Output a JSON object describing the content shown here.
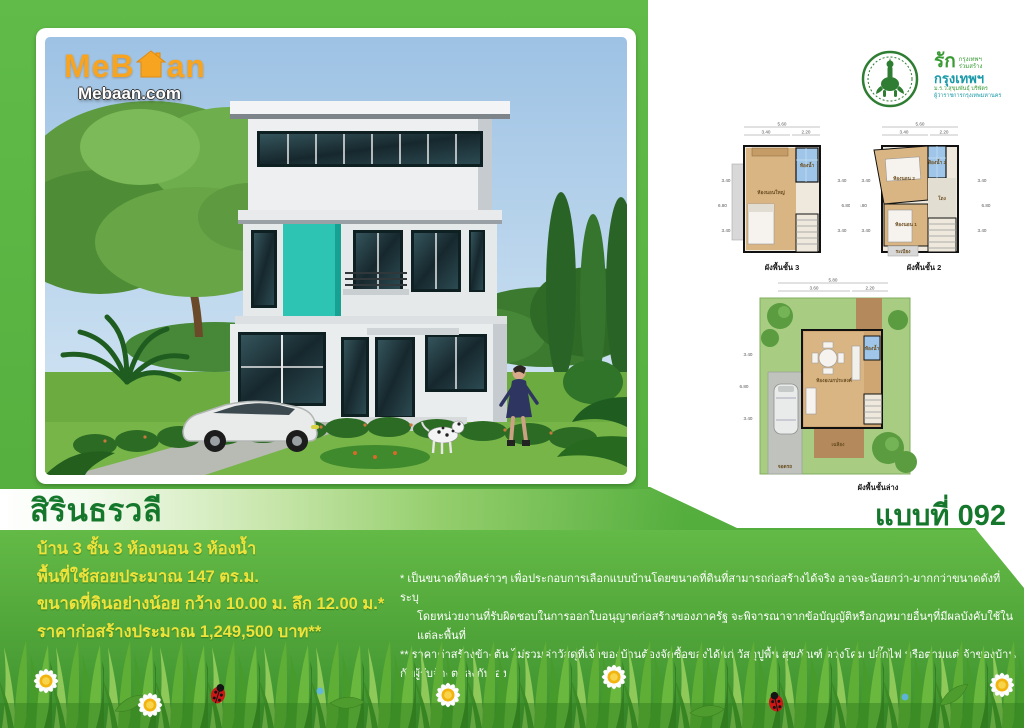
{
  "brand": {
    "name_part1": "MeB",
    "name_part2": "an",
    "house_icon": "house-icon",
    "site": "Mebaan.com"
  },
  "header": {
    "model_label": "แบบที่ 092",
    "campaign": {
      "love": "รัก",
      "top_small_1": "กรุงเทพฯ",
      "top_small_2": "ร่วมสร้าง",
      "main": "กรุงเทพฯ",
      "sub1": "ม.ร.ว.สุขุมพันธุ์ บริพัตร",
      "sub2": "ผู้ว่าราชการกรุงเทพมหานคร"
    }
  },
  "title": {
    "name": "สิรินธรวลี"
  },
  "specs": {
    "lines": [
      "บ้าน 3 ชั้น 3 ห้องนอน 3 ห้องน้ำ",
      "พื้นที่ใช้สอยประมาณ 147 ตร.ม.",
      "ขนาดที่ดินอย่างน้อย กว้าง 10.00 ม. ลึก 12.00 ม.*",
      "ราคาก่อสร้างประมาณ 1,249,500 บาท**"
    ]
  },
  "disclaimer": {
    "lines": [
      "* เป็นขนาดที่ดินคร่าวๆ  เพื่อประกอบการเลือกแบบบ้านโดยขนาดที่ดินที่สามารถก่อสร้างได้จริง  อาจจะน้อยกว่า-มากกว่าขนาดดังที่ระบุ",
      "โดยหน่วยงานที่รับผิดชอบในการออกใบอนุญาตก่อสร้างของภาครัฐ  จะพิจารณาจากข้อบัญญัติหรือกฎหมายอื่นๆที่มีผลบังคับใช้ในแต่ละพื้นที่",
      "** ราคาค่าสร้างข้างต้น ไม่รวมค่าวัสดุที่เจ้าของบ้านต้องจัดซื้อของได้แก่ วัสดุปูพื้น สุขภัณฑ์ ดวงโคม ปลั๊กไฟ หรือตามแต่เจ้าของบ้านกับผู้รับจ้างตกลงกันเอง"
    ]
  },
  "plans": {
    "floor3": {
      "caption": "ผังพื้นชั้น 3",
      "dims_top": [
        "5.60",
        "3.40",
        "2.20"
      ],
      "dims_side": [
        "3.40",
        "6.80",
        "3.40"
      ],
      "room_master": "ห้องนอนใหญ่",
      "room_bath": "ห้องน้ำ"
    },
    "floor2": {
      "caption": "ผังพื้นชั้น 2",
      "dims_top": [
        "5.60",
        "3.40",
        "2.20"
      ],
      "dims_side": [
        "3.40",
        "6.80",
        "3.40"
      ],
      "room_bed2": "ห้องนอน 2",
      "room_bed1": "ห้องนอน 1",
      "room_bath": "ห้องน้ำ 2",
      "room_hall": "โถง",
      "room_balcony": "ระเบียง"
    },
    "floor1": {
      "caption": "ผังพื้นชั้นล่าง",
      "dims_top": [
        "5.80",
        "3.60",
        "2.20"
      ],
      "dims_side": [
        "3.40",
        "6.80",
        "3.40"
      ],
      "room_multi": "ห้องอเนกประสงค์",
      "room_porch": "เฉลียง",
      "room_park": "จอดรถ",
      "room_bath": "ห้องน้ำ"
    }
  },
  "colors": {
    "green_main": "#5cb947",
    "green_dark_text": "#15772b",
    "yellow_text": "#eee23b",
    "brand_orange": "#f7a420",
    "teal_accent": "#2ec4b4",
    "sky_blue": "#a6c6e4",
    "bma_green": "#2e7d32",
    "campaign_teal": "#1899a8"
  }
}
